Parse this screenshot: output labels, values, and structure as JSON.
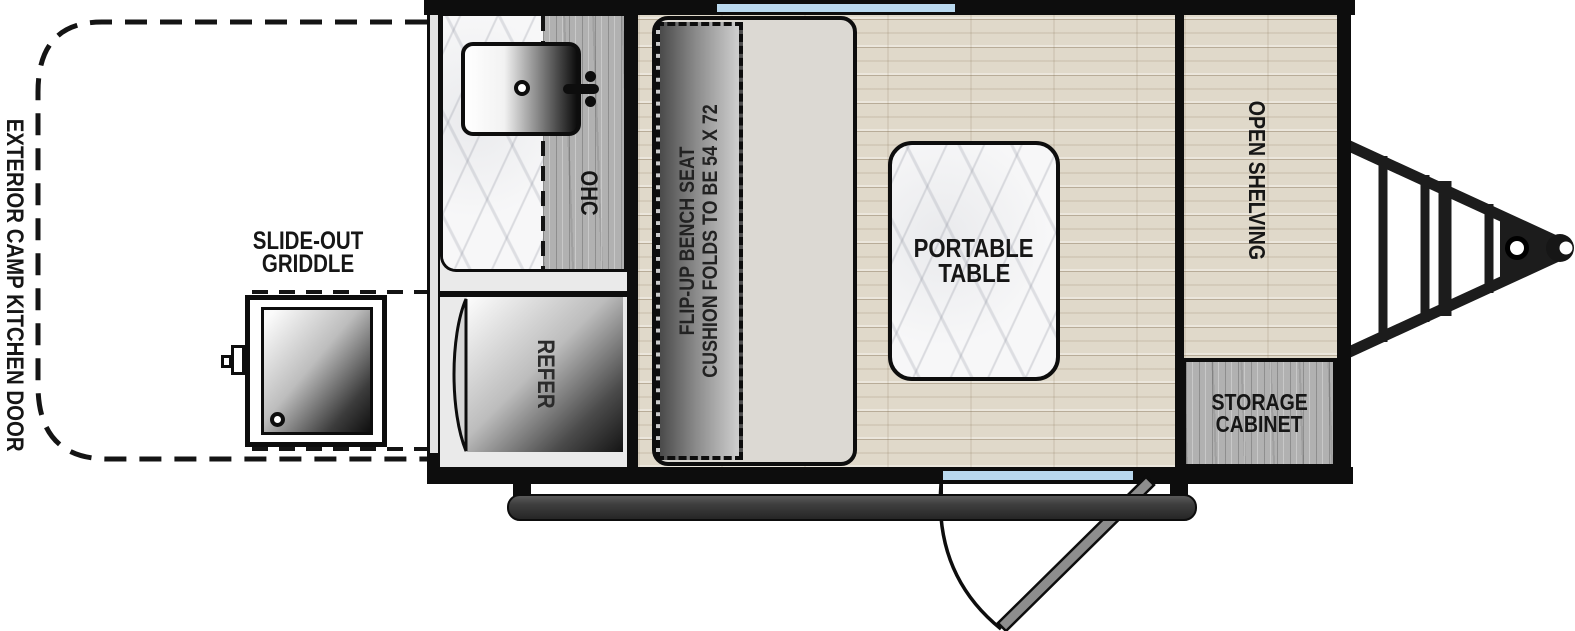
{
  "diagram": {
    "type": "travel-trailer-floorplan",
    "exterior": {
      "camp_kitchen_door_label": "EXTERIOR CAMP KITCHEN DOOR",
      "griddle_label_line1": "SLIDE-OUT",
      "griddle_label_line2": "GRIDDLE"
    },
    "kitchen": {
      "overhead_cabinet_label": "OHC",
      "refrigerator_label": "REFER"
    },
    "main_room": {
      "bench_label_line1": "FLIP-UP BENCH SEAT",
      "bench_label_line2": "CUSHION FOLDS TO BE 54 X 72",
      "table_label_line1": "PORTABLE",
      "table_label_line2": "TABLE"
    },
    "front": {
      "open_shelving_label": "OPEN SHELVING",
      "storage_cabinet_label_line1": "STORAGE",
      "storage_cabinet_label_line2": "CABINET"
    },
    "colors": {
      "wall": "#0d0d0d",
      "window_glass": "#b9d8ee",
      "floor_wood": "#e0d9ca",
      "cabinet_gray_wood": "#b1b1b1",
      "bench": "#dcd9d3",
      "step": "#3f3f3f",
      "door_panel": "#8d8d8d"
    }
  }
}
